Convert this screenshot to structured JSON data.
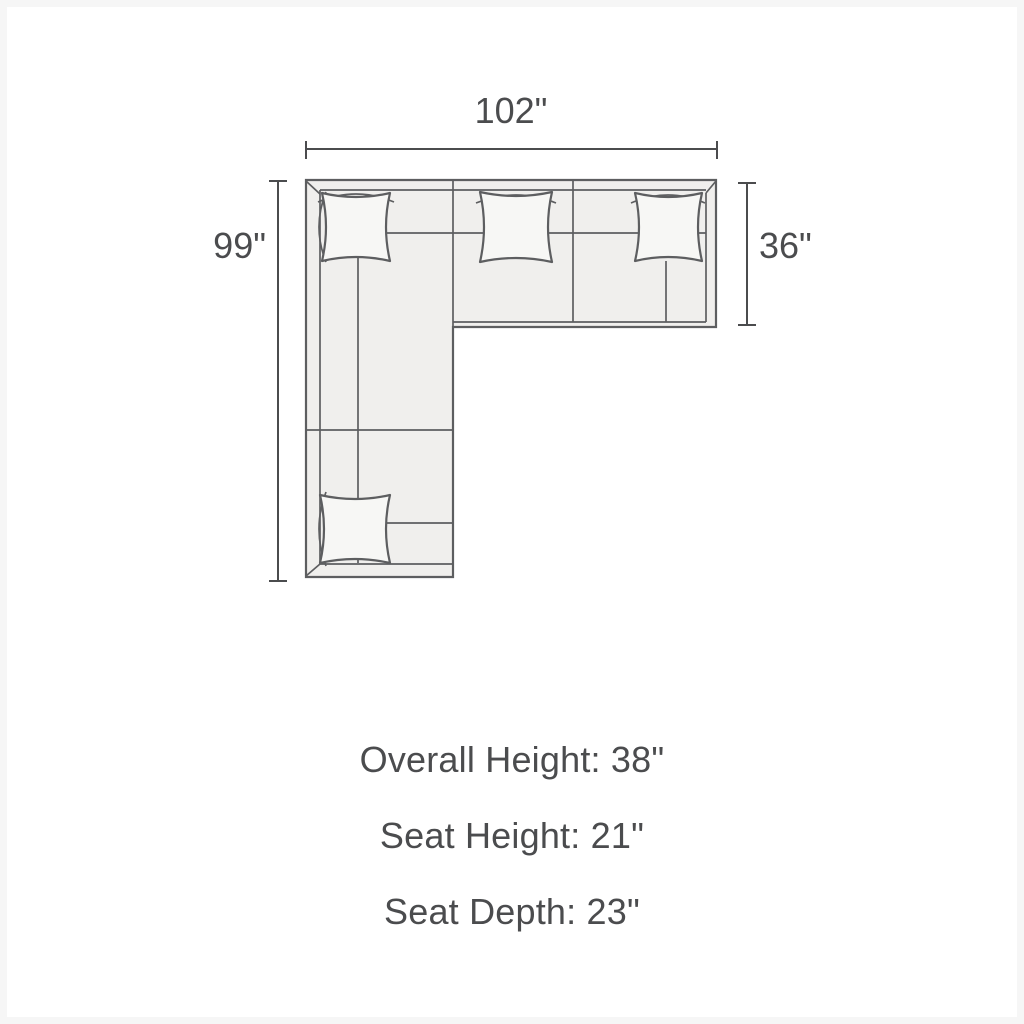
{
  "diagram": {
    "width_label": "102\"",
    "height_label": "99\"",
    "depth_label": "36\"",
    "colors": {
      "background": "#ffffff",
      "sofa_fill": "#f0efed",
      "pillow_fill": "#f7f7f5",
      "sofa_line": "#5d5e60",
      "dimension_line": "#4b4c4e",
      "text": "#4b4c4e"
    }
  },
  "specs": {
    "lines": [
      "Overall Height: 38\"",
      "Seat Height: 21\"",
      "Seat Depth: 23\""
    ]
  }
}
